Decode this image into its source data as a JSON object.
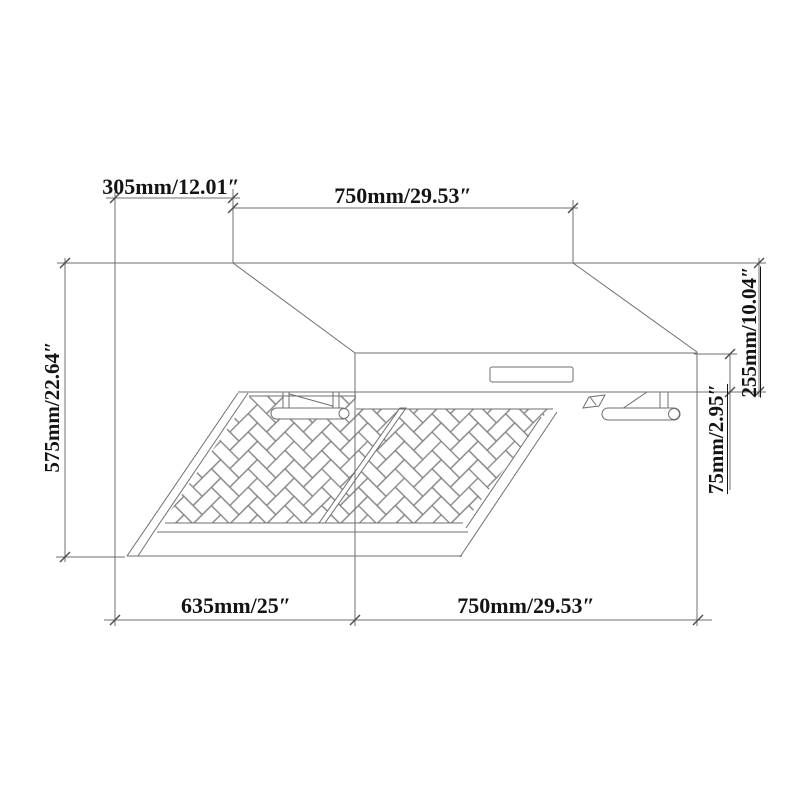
{
  "diagram": {
    "kind": "range-hood dimensional technical drawing",
    "labels": {
      "top_offset": "305mm/12.01″",
      "top_width": "750mm/29.53″",
      "left_height": "575mm/22.64″",
      "right_height": "255mm/10.04″",
      "right_lip_height": "75mm/2.95″",
      "bottom_depth": "635mm/25″",
      "bottom_width": "750mm/29.53″"
    },
    "colors": {
      "background": "#ffffff",
      "drawing_line": "#6f6f6f",
      "pattern_line": "#828282",
      "tick": "#4a4a4a",
      "text": "#141414"
    }
  }
}
